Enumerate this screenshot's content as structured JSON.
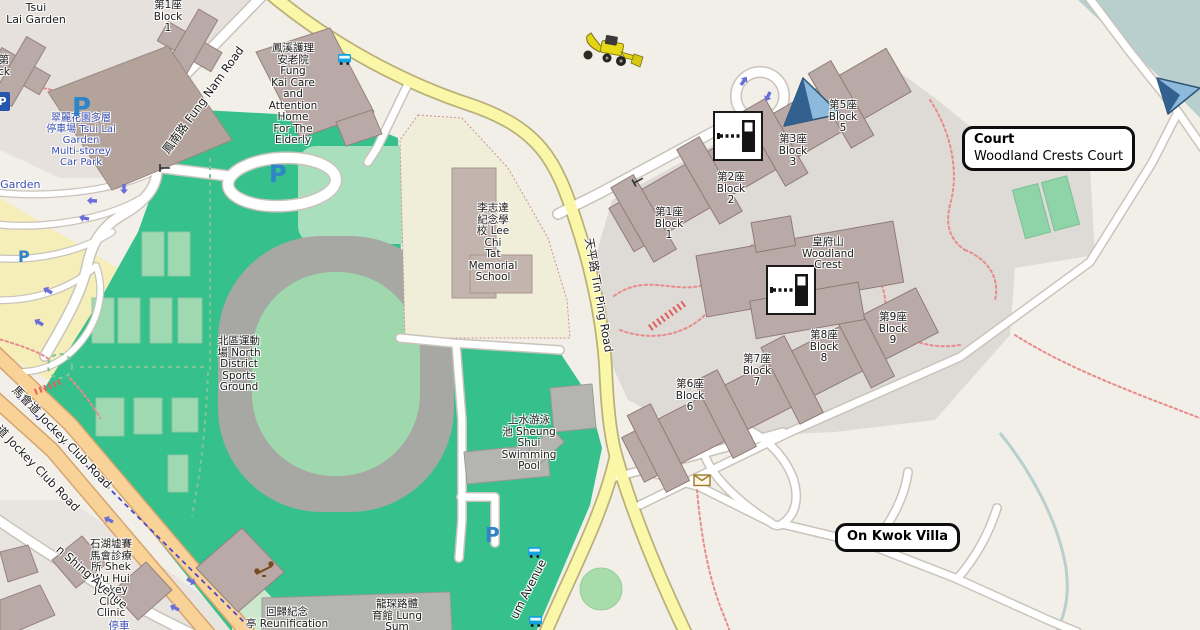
{
  "map_title": "OpenStreetMap style map - Sheung Shui area",
  "L": {
    "tsui_lai": [
      "Tsui",
      "Lai Garden"
    ],
    "blk1_tsui": [
      "第1座",
      "Block",
      "1"
    ],
    "cut_blk": [
      "第",
      "ck"
    ],
    "car_park": [
      "翠麗花園多層",
      "停車場 Tsui Lai",
      "Garden",
      "Multi-storey",
      "Car Park"
    ],
    "i_garden": "i Garden",
    "fung_kai": [
      "鳳溪護理",
      "安老院",
      "Fung",
      "Kai Care",
      "and",
      "Attention",
      "Home",
      "For The",
      "Elderly"
    ],
    "lee_chi_tat": [
      "李志達",
      "紀念學",
      "校 Lee",
      "Chi",
      "Tat",
      "Memorial",
      "School"
    ],
    "north_district": [
      "北區運動",
      "場 North",
      "District",
      "Sports",
      "Ground"
    ],
    "sheung_shui": [
      "上水游泳",
      "池 Sheung",
      "Shui",
      "Swimming",
      "Pool"
    ],
    "woodland": [
      "皇府山",
      "Woodland",
      "Crest"
    ],
    "wb1": [
      "第1座",
      "Block",
      "1"
    ],
    "wb2": [
      "第2座",
      "Block",
      "2"
    ],
    "wb3": [
      "第3座",
      "Block",
      "3"
    ],
    "wb5": [
      "第5座",
      "Block",
      "5"
    ],
    "wb6": [
      "第6座",
      "Block",
      "6"
    ],
    "wb7": [
      "第7座",
      "Block",
      "7"
    ],
    "wb8": [
      "第8座",
      "Block",
      "8"
    ],
    "wb9": [
      "第9座",
      "Block",
      "9"
    ],
    "clinic": [
      "石湖墟賽",
      "馬會診療",
      "所 Shek",
      "Wu Hui",
      "Jockey",
      "Club",
      "Clinic"
    ],
    "reunification": [
      "回歸紀念",
      "亭 Reunification"
    ],
    "lung_sum_b": [
      "龍琛路體",
      "育館 Lung",
      "Sum"
    ],
    "blue_cut": "停車"
  },
  "roads": {
    "fung_nam": "鳳南路 Fung Nam Road",
    "tin_ping": "天平路 Tin Ping Road",
    "jockey": "馬會道 Jockey Club Road",
    "san_shing": "n Shing Avenue",
    "lung_sum_ave": "um Avenue"
  },
  "callouts": {
    "court": {
      "title": "Court",
      "subtitle": "Woodland Crests Court"
    },
    "on_kwok": {
      "title": "On Kwok Villa"
    }
  },
  "markers": {
    "parking_letter": "P"
  },
  "icons": [
    "parking-p",
    "parking-sign",
    "bus-stop-icon",
    "lift-gate-icon",
    "viewpoint-arrow-icon",
    "post-box-icon",
    "excavator-icon",
    "playground-icon",
    "gate-icon",
    "oneway-arrow-icon"
  ],
  "palette": {
    "land": "#f2efe9",
    "residential": "#e6e1dc",
    "estate_ground": "#dedad6",
    "green": "#35c08c",
    "pitch_light": "#9fd8ad",
    "track_gray": "#a7a7a4",
    "school_beige": "#f0eed8",
    "parking_yellow": "#f5eeb9",
    "water": "#b8cfce",
    "building": "#b9a9a7",
    "building_gray": "#b4b4b0",
    "road_yellow": "#fbf7a8",
    "road_orange": "#f9d297",
    "road_white": "#ffffff",
    "label_blue": "#3c50b4",
    "parking_blue": "#2e86c8",
    "bus_blue": "#12a3e0",
    "callout_border": "#0d0d0d",
    "path_red": "#e88b8b",
    "path_green": "#7ec695",
    "cycle_blue": "#4949c8",
    "marker_blue_dark": "#33618f",
    "marker_blue_light": "#8db9dc"
  }
}
